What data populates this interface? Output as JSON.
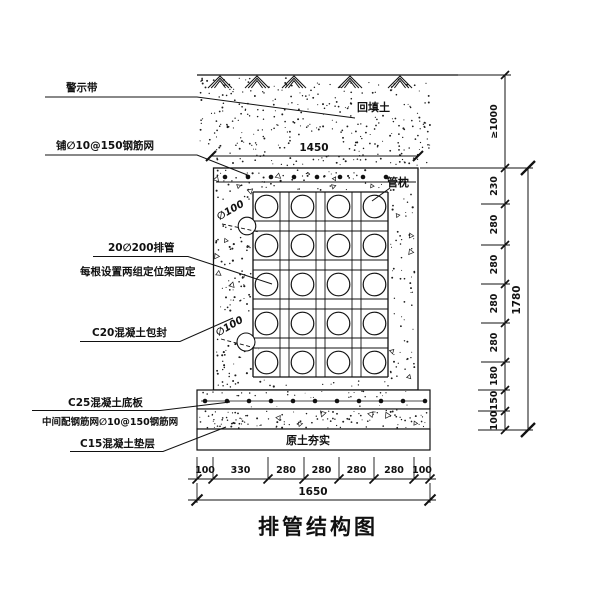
{
  "title": "排管结构图",
  "labels": {
    "warning_tape": "警示带",
    "top_mesh": "铺∅10@150钢筋网",
    "backfill_soil": "回填土",
    "pipe_support": "管枕",
    "pipes_line1": "20∅200排管",
    "pipes_line2": "每根设置两组定位架固定",
    "drain_dia_upper": "∅100",
    "drain_dia_lower": "∅100",
    "encasement": "C20混凝土包封",
    "base_slab": "C25混凝土底板",
    "slab_mesh": "中间配钢筋网∅10@150钢筋网",
    "cushion": "C15混凝土垫层",
    "compacted_soil": "原土夯实"
  },
  "dimensions": {
    "top_width": "1450",
    "cover_depth": "≥1000",
    "right_segments": [
      "230",
      "280",
      "280",
      "280",
      "280",
      "180",
      "150",
      "100"
    ],
    "right_total": "1780",
    "bottom_segments": [
      "100",
      "330",
      "280",
      "280",
      "280",
      "280",
      "100"
    ],
    "bottom_total": "1650"
  },
  "colors": {
    "ink": "#111111",
    "paper": "#ffffff"
  }
}
